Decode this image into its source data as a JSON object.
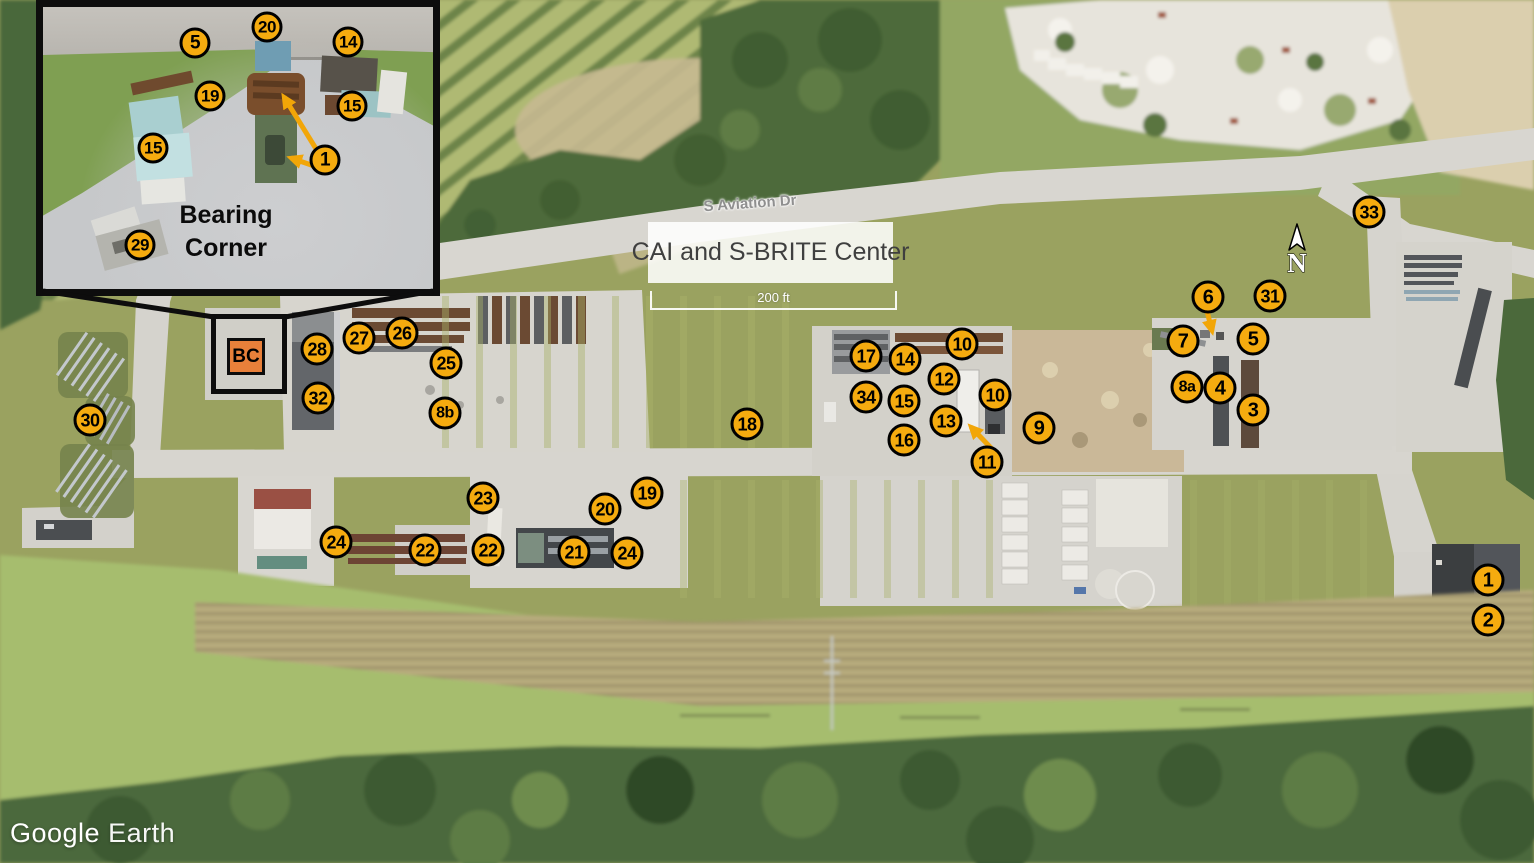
{
  "labels": {
    "title": "CAI and S-BRITE Center",
    "road": "S Aviation Dr",
    "scale": "200 ft",
    "north": "N",
    "inset_caption_line1": "Bearing",
    "inset_caption_line2": "Corner",
    "bc_label": "BC"
  },
  "logo": {
    "google": "Google",
    "earth": "Earth"
  },
  "colors": {
    "marker_fill": "#F5AB0F",
    "marker_border": "#000000",
    "arrow": "#F2A608",
    "bc_fill": "#E8803A",
    "title_text": "#3F3F3F"
  },
  "map_markers": [
    {
      "label": "33",
      "x": 1369,
      "y": 212
    },
    {
      "label": "6",
      "x": 1208,
      "y": 297
    },
    {
      "label": "31",
      "x": 1270,
      "y": 296
    },
    {
      "label": "7",
      "x": 1183,
      "y": 341
    },
    {
      "label": "5",
      "x": 1253,
      "y": 339
    },
    {
      "label": "8a",
      "x": 1187,
      "y": 387
    },
    {
      "label": "4",
      "x": 1220,
      "y": 388
    },
    {
      "label": "3",
      "x": 1253,
      "y": 410
    },
    {
      "label": "30",
      "x": 90,
      "y": 420
    },
    {
      "label": "28",
      "x": 317,
      "y": 349
    },
    {
      "label": "27",
      "x": 359,
      "y": 338
    },
    {
      "label": "26",
      "x": 402,
      "y": 333
    },
    {
      "label": "25",
      "x": 446,
      "y": 363
    },
    {
      "label": "32",
      "x": 318,
      "y": 398
    },
    {
      "label": "8b",
      "x": 445,
      "y": 413
    },
    {
      "label": "18",
      "x": 747,
      "y": 424
    },
    {
      "label": "17",
      "x": 866,
      "y": 356
    },
    {
      "label": "14",
      "x": 905,
      "y": 359
    },
    {
      "label": "10",
      "x": 962,
      "y": 344
    },
    {
      "label": "12",
      "x": 944,
      "y": 379
    },
    {
      "label": "34",
      "x": 866,
      "y": 397
    },
    {
      "label": "15",
      "x": 904,
      "y": 401
    },
    {
      "label": "10",
      "x": 995,
      "y": 395
    },
    {
      "label": "13",
      "x": 946,
      "y": 421
    },
    {
      "label": "16",
      "x": 904,
      "y": 440
    },
    {
      "label": "11",
      "x": 987,
      "y": 462
    },
    {
      "label": "9",
      "x": 1039,
      "y": 428
    },
    {
      "label": "23",
      "x": 483,
      "y": 498
    },
    {
      "label": "19",
      "x": 647,
      "y": 493
    },
    {
      "label": "20",
      "x": 605,
      "y": 509
    },
    {
      "label": "24",
      "x": 336,
      "y": 542
    },
    {
      "label": "22",
      "x": 425,
      "y": 550
    },
    {
      "label": "22",
      "x": 488,
      "y": 550
    },
    {
      "label": "21",
      "x": 574,
      "y": 552
    },
    {
      "label": "24",
      "x": 627,
      "y": 553
    },
    {
      "label": "1",
      "x": 1488,
      "y": 580
    },
    {
      "label": "2",
      "x": 1488,
      "y": 620
    }
  ],
  "inset_markers": [
    {
      "label": "5",
      "x": 195,
      "y": 43
    },
    {
      "label": "20",
      "x": 267,
      "y": 27
    },
    {
      "label": "14",
      "x": 348,
      "y": 42
    },
    {
      "label": "19",
      "x": 210,
      "y": 96
    },
    {
      "label": "15",
      "x": 352,
      "y": 106
    },
    {
      "label": "15",
      "x": 153,
      "y": 148
    },
    {
      "label": "1",
      "x": 325,
      "y": 160
    },
    {
      "label": "29",
      "x": 140,
      "y": 245
    }
  ],
  "arrows": [
    {
      "from": [
        318,
        152
      ],
      "to": [
        284,
        97
      ]
    },
    {
      "from": [
        317,
        167
      ],
      "to": [
        291,
        158
      ]
    },
    {
      "from": [
        1207,
        311
      ],
      "to": [
        1212,
        331
      ]
    },
    {
      "from": [
        992,
        449
      ],
      "to": [
        971,
        427
      ]
    }
  ]
}
